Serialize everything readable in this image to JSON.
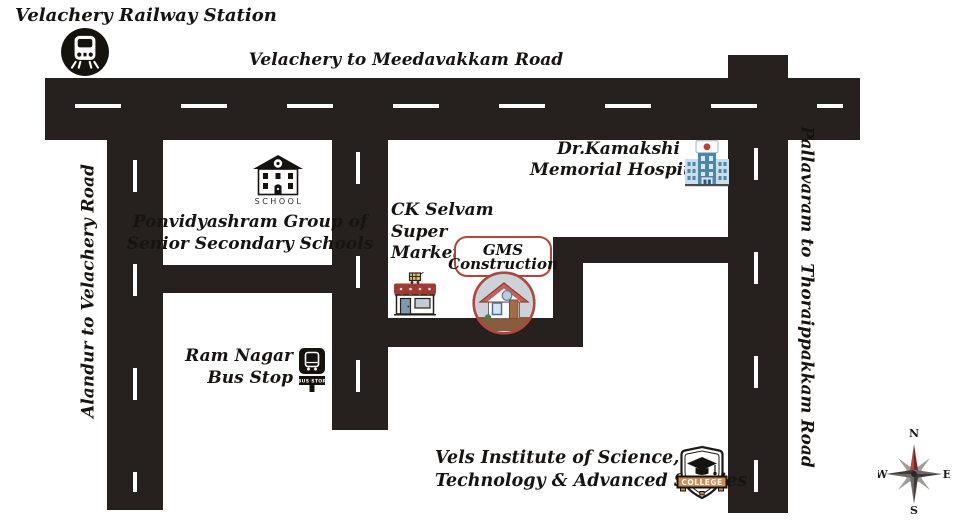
{
  "station": {
    "label": "Velachery Railway Station"
  },
  "roads": {
    "top": "Velachery to Meedavakkam Road",
    "left": "Alandur to Velachery Road",
    "right": "Pallavaram to Thoraippakkam Road"
  },
  "school": {
    "line1": "Ponvidyashram Group of",
    "line2": "Senior Secondary Schools",
    "caption": "SCHOOL"
  },
  "hospital": {
    "line1": "Dr.Kamakshi",
    "line2": "Memorial Hospital"
  },
  "supermarket": {
    "line1": "CK Selvam",
    "line2": "Super",
    "line3": "Market"
  },
  "gms": {
    "line1": "GMS",
    "line2": "Construction"
  },
  "bus_stop": {
    "line1": "Ram Nagar",
    "line2": "Bus Stop",
    "sign": "BUS STOP"
  },
  "college": {
    "line1": "Vels Institute of Science,",
    "line2": "Technology & Advanced Studies",
    "badge": "COLLEGE"
  },
  "compass": {
    "n": "N",
    "e": "E",
    "s": "S",
    "w": "W"
  },
  "colors": {
    "road": "#26211e",
    "accent_red": "#b5453c",
    "hospital_blue": "#4e86a8",
    "banner_orange": "#d08c4f",
    "compass_north_red": "#8e2f28",
    "house_ground_brown": "#8a5c3e"
  }
}
